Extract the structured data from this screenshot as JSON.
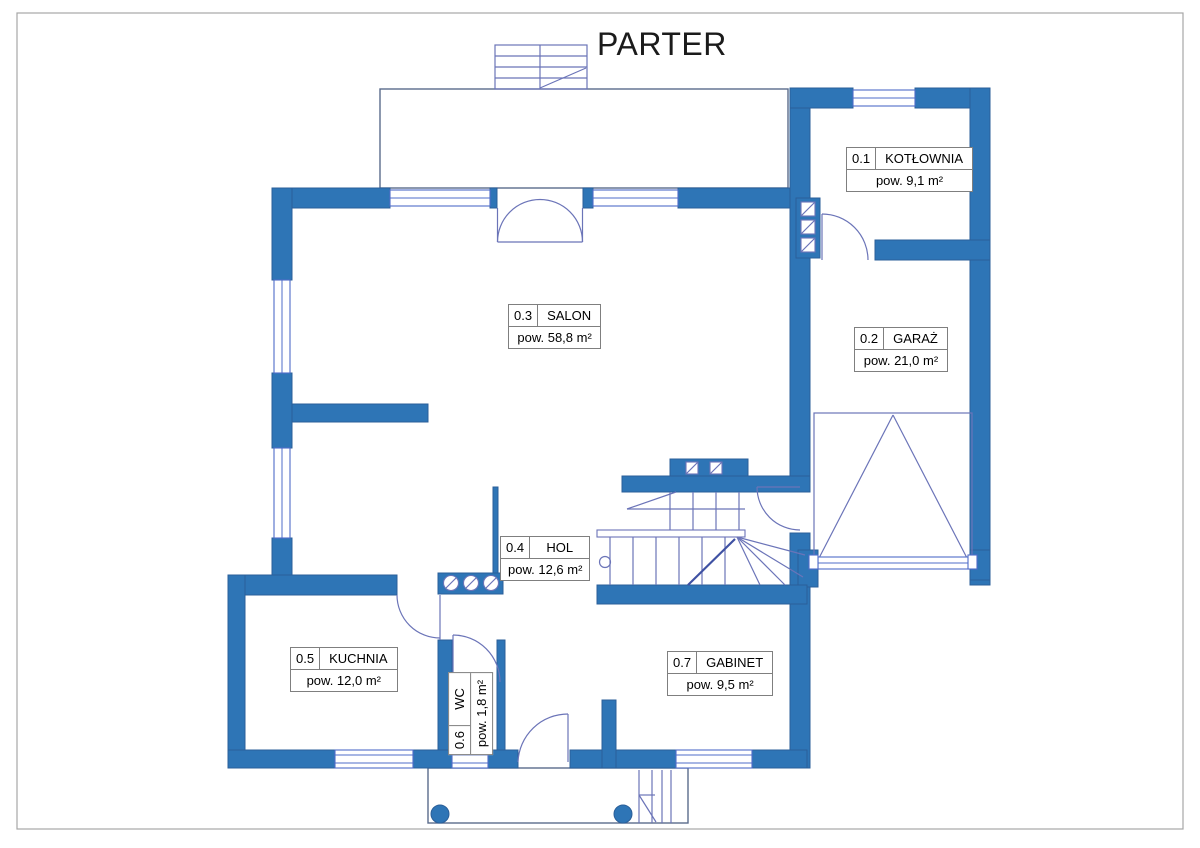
{
  "title": "PARTER",
  "rooms": [
    {
      "id": "0.1",
      "name": "KOTŁOWNIA",
      "area": "pow. 9,1 m²"
    },
    {
      "id": "0.2",
      "name": "GARAŻ",
      "area": "pow. 21,0 m²"
    },
    {
      "id": "0.3",
      "name": "SALON",
      "area": "pow. 58,8 m²"
    },
    {
      "id": "0.4",
      "name": "HOL",
      "area": "pow. 12,6 m²"
    },
    {
      "id": "0.5",
      "name": "KUCHNIA",
      "area": "pow. 12,0 m²"
    },
    {
      "id": "0.6",
      "name": "WC",
      "area": "pow. 1,8 m²"
    },
    {
      "id": "0.7",
      "name": "GABINET",
      "area": "pow. 9,5 m²"
    }
  ],
  "colors": {
    "wall": "#2e75b6",
    "wallStroke": "#2b5f99",
    "line": "#6b74b8",
    "win": "#4f6cc8",
    "outline": "#5a6b8c",
    "border": "#a6a6a6",
    "title": "#1b1b1b",
    "labelBorder": "#7f7f7f"
  }
}
